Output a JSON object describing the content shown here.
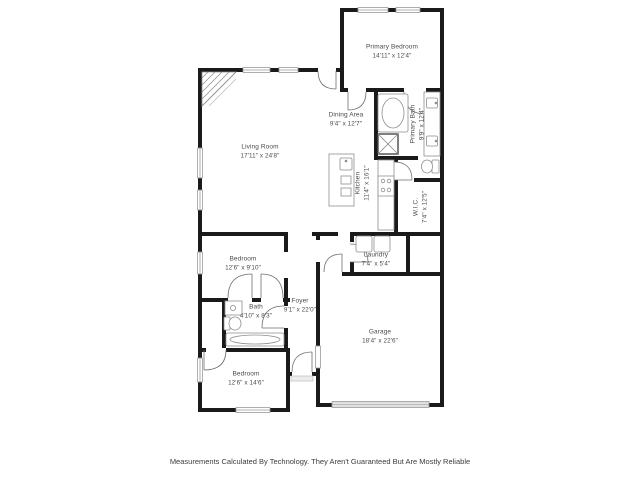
{
  "floorplan": {
    "disclaimer": "Measurements Calculated By Technology. They Aren't Guaranteed But Are Mostly Reliable",
    "rooms": [
      {
        "id": "primary-bedroom",
        "name": "Primary Bedroom",
        "dims": "14'11\" x 12'4\""
      },
      {
        "id": "dining-area",
        "name": "Dining Area",
        "dims": "9'4\" x 12'7\""
      },
      {
        "id": "living-room",
        "name": "Living Room",
        "dims": "17'11\" x 24'8\""
      },
      {
        "id": "primary-bath",
        "name": "Primary Bath",
        "dims": "9'9\" x 12'4\""
      },
      {
        "id": "kitchen",
        "name": "Kitchen",
        "dims": "11'4\" x 16'1\""
      },
      {
        "id": "wic",
        "name": "W.I.C.",
        "dims": "7'4\" x 12'5\""
      },
      {
        "id": "laundry",
        "name": "Laundry",
        "dims": "7'4\" x 5'4\""
      },
      {
        "id": "bedroom-1",
        "name": "Bedroom",
        "dims": "12'6\" x 9'10\""
      },
      {
        "id": "bath",
        "name": "Bath",
        "dims": "4'10\" x 8'3\""
      },
      {
        "id": "foyer",
        "name": "Foyer",
        "dims": "9'1\" x 22'0\""
      },
      {
        "id": "bedroom-2",
        "name": "Bedroom",
        "dims": "12'6\" x 14'6\""
      },
      {
        "id": "garage",
        "name": "Garage",
        "dims": "18'4\" x 22'6\""
      }
    ],
    "colors": {
      "wall": "#1a1a1a",
      "fixture": "#8f8f8f",
      "door": "#6e6e6e",
      "window_stroke": "#9a9a9a",
      "label": "#4a4a4a",
      "disclaimer": "#3c3c3c"
    }
  }
}
